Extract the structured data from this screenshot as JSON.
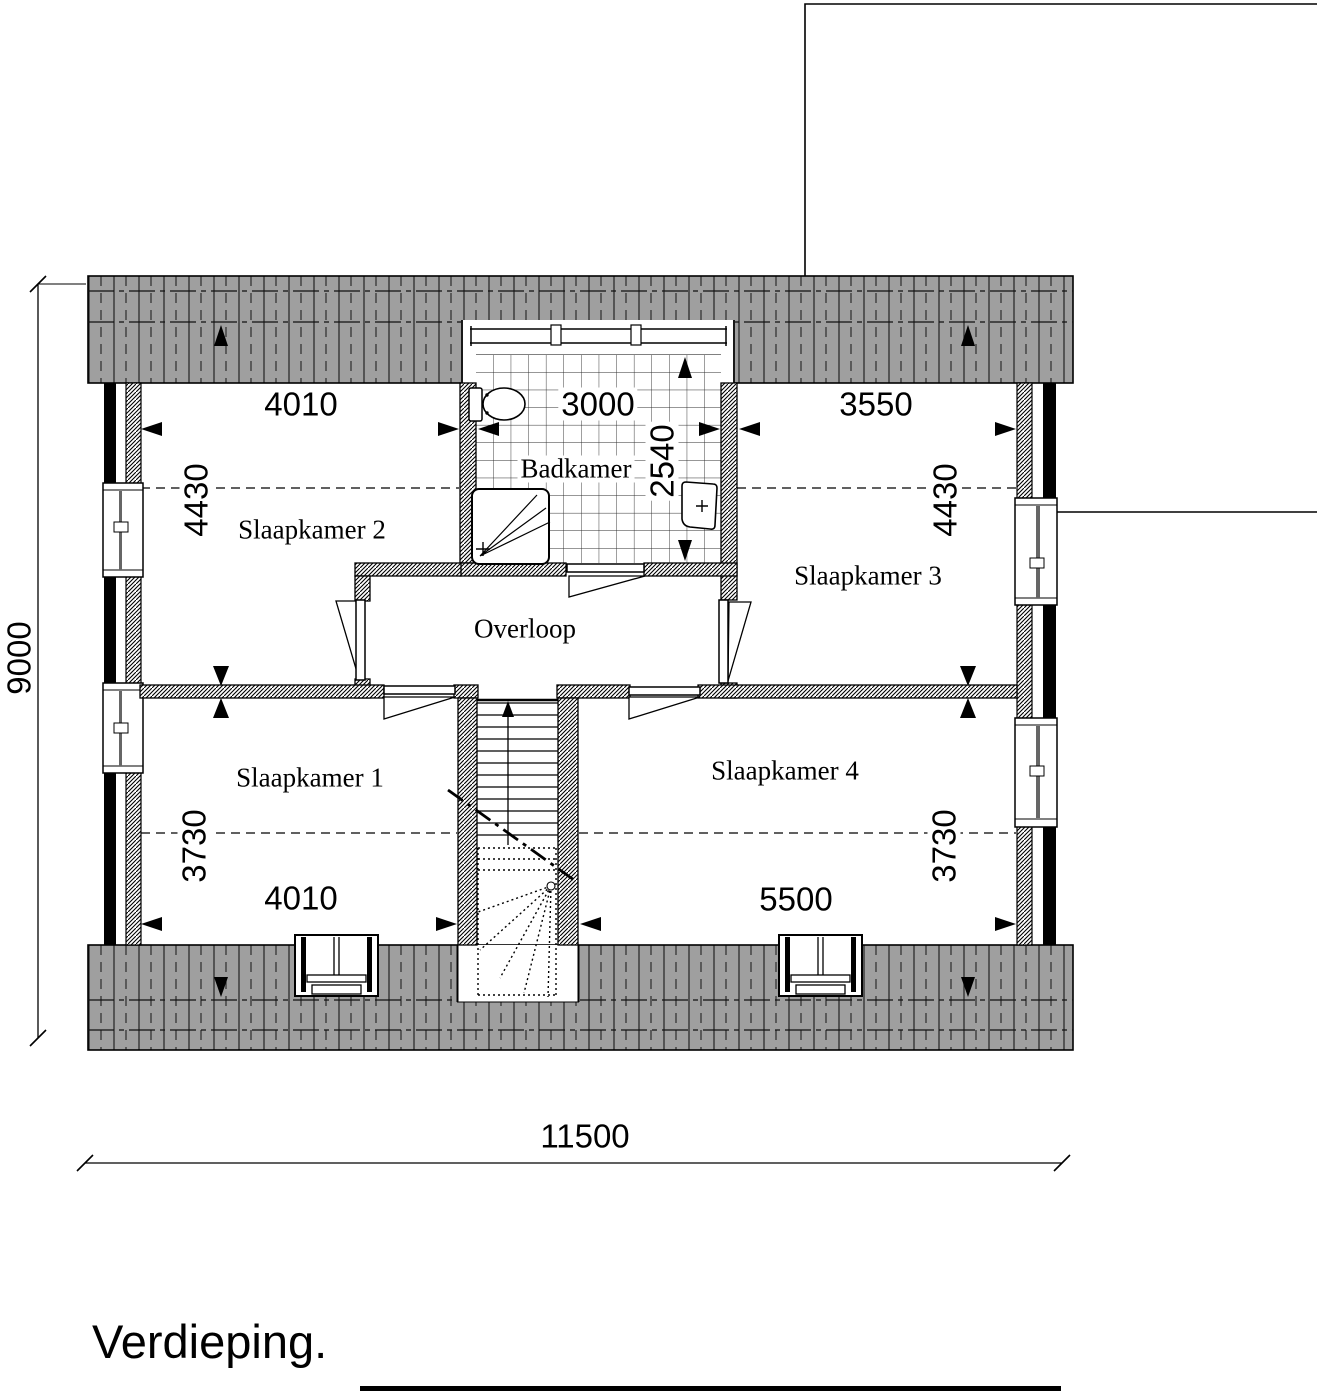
{
  "title": "Verdieping.",
  "rooms": {
    "slaapkamer1": "Slaapkamer 1",
    "slaapkamer2": "Slaapkamer 2",
    "slaapkamer3": "Slaapkamer 3",
    "slaapkamer4": "Slaapkamer 4",
    "badkamer": "Badkamer",
    "overloop": "Overloop"
  },
  "dimensions": {
    "top_left_width": "4010",
    "bathroom_width": "3000",
    "top_right_width": "3550",
    "upper_left_depth": "4430",
    "upper_right_depth": "4430",
    "bathroom_depth": "2540",
    "lower_left_depth": "3730",
    "lower_right_depth": "3730",
    "bottom_left_width": "4010",
    "bottom_right_width": "5500",
    "total_depth": "9000",
    "total_width": "11500"
  },
  "colors": {
    "roof_gray": "#9f9f9f",
    "line": "#000000",
    "background": "#ffffff"
  }
}
